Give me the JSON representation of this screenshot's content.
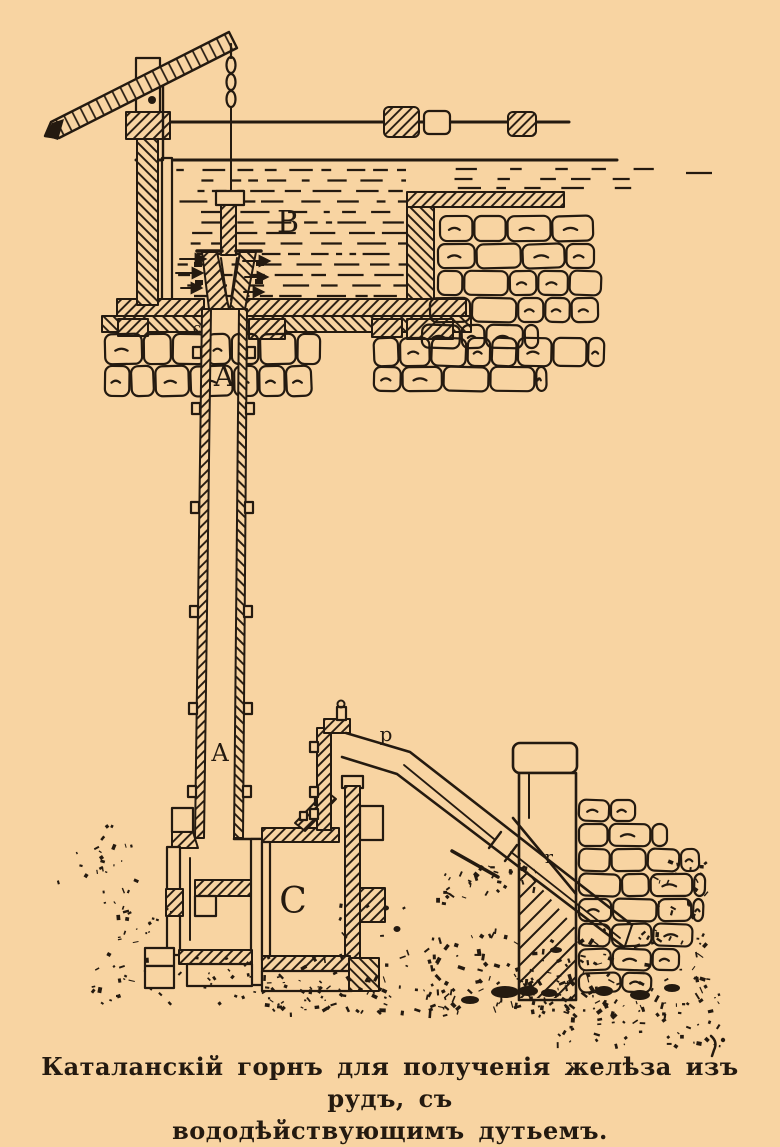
{
  "figure": {
    "type": "engraving-diagram",
    "labels": {
      "upper_pipe": "A",
      "lower_pipe": "A",
      "reservoir": "B",
      "air_chest": "C",
      "small_c": "c",
      "blast_pipe": "p",
      "hearth": "r"
    },
    "caption": {
      "line1": "Каталанскій горнъ для полученія желѣза изъ рудъ, съ",
      "line2": "вододѣйствующимъ дутьемъ."
    },
    "colors": {
      "paper": "#f8d4a2",
      "ink": "#241a10"
    }
  }
}
